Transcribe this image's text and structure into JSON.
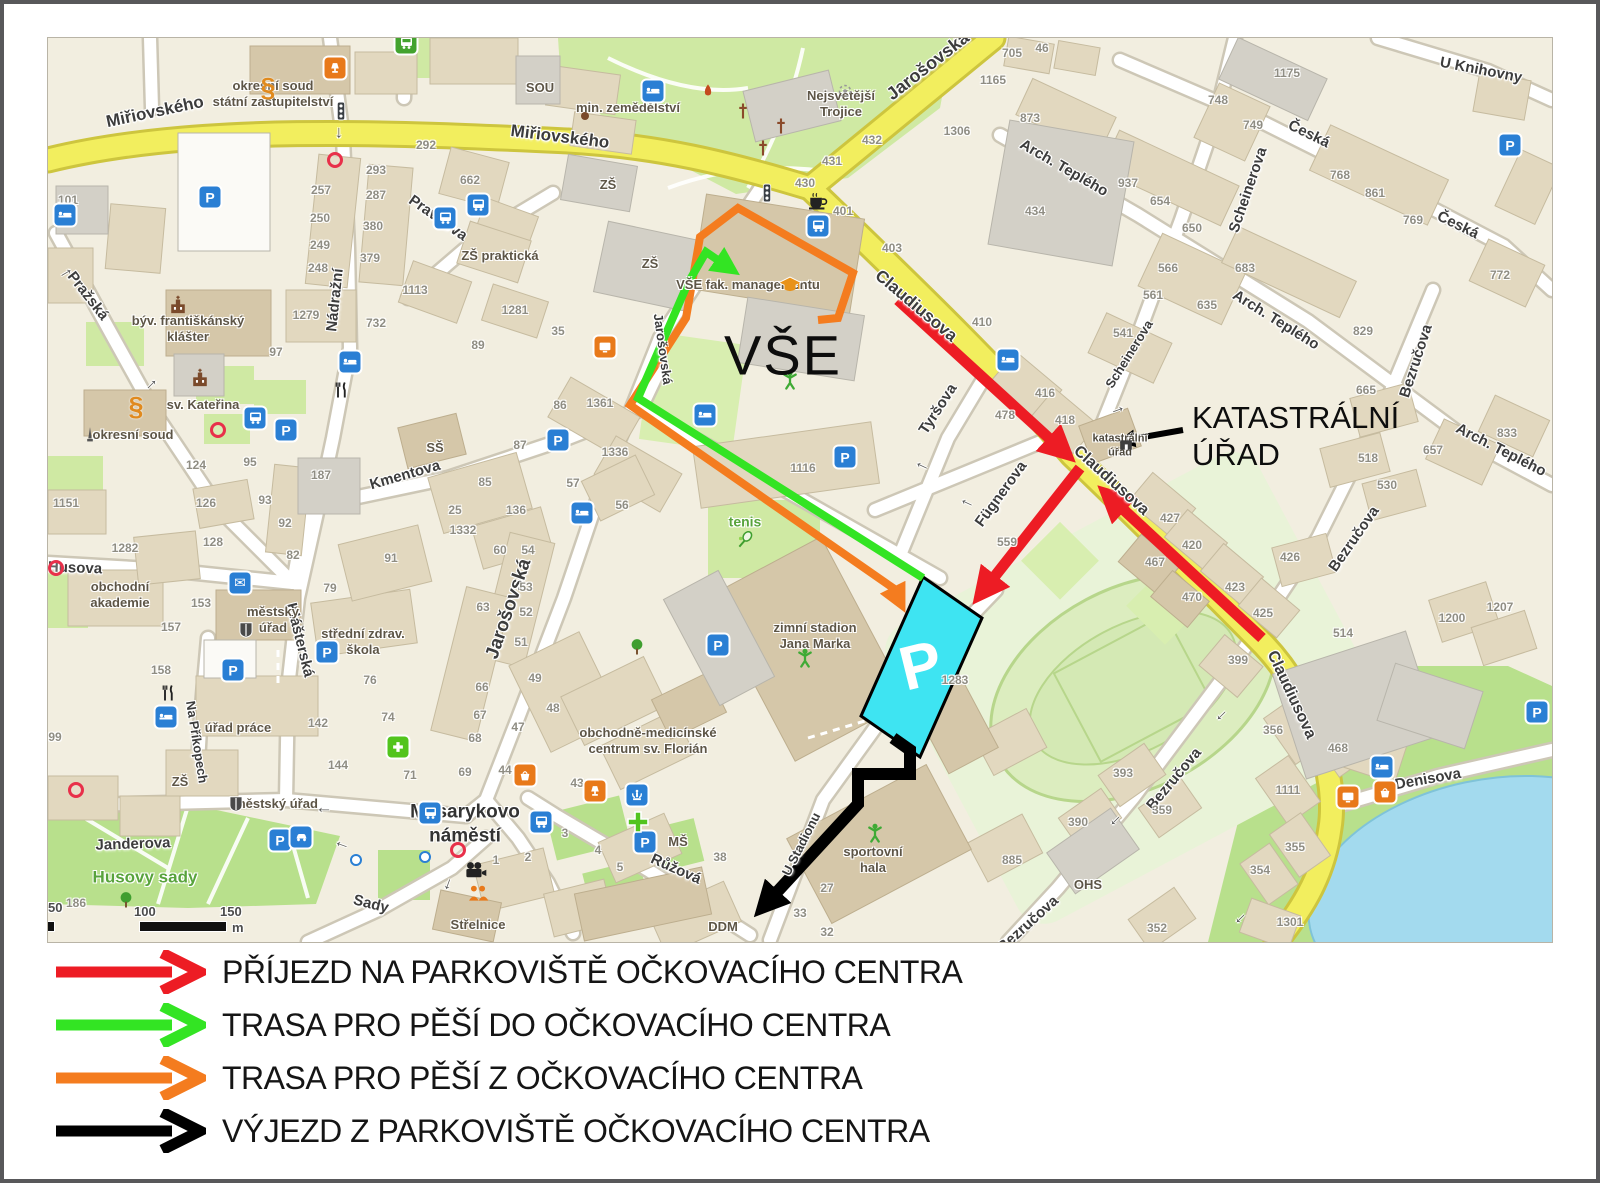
{
  "colors": {
    "route_arrival": "#ed1c24",
    "route_walk_to": "#33e423",
    "route_walk_from": "#f47c1f",
    "route_exit": "#000000",
    "parking_fill": "#3ee4f2",
    "road_main": "#f2ee5e",
    "water": "#a3daee"
  },
  "legend": {
    "items": [
      {
        "id": "arrival",
        "color": "#ed1c24",
        "label": "PŘÍJEZD NA PARKOVIŠTĚ OČKOVACÍHO CENTRA"
      },
      {
        "id": "walk-to",
        "color": "#33e423",
        "label": "TRASA PRO PĚŠÍ DO OČKOVACÍHO CENTRA"
      },
      {
        "id": "walk-from",
        "color": "#f47c1f",
        "label": "TRASA PRO PĚŠÍ Z OČKOVACÍHO CENTRA"
      },
      {
        "id": "exit",
        "color": "#000000",
        "label": "VÝJEZD Z PARKOVIŠTĚ OČKOVACÍHO CENTRA"
      }
    ]
  },
  "map": {
    "big_label": "VŠE",
    "parking_letter": "P",
    "callout": {
      "line1": "KATASTRÁLNÍ",
      "line2": "ÚŘAD"
    },
    "scale": {
      "t50": "50",
      "t100": "100",
      "t150": "150",
      "unit": "m"
    },
    "street_labels": [
      {
        "t": "Miřiovského",
        "x": 107,
        "y": 74,
        "r": -12,
        "s": 17
      },
      {
        "t": "Miřiovského",
        "x": 512,
        "y": 99,
        "r": 7,
        "s": 17
      },
      {
        "t": "Jarošovská",
        "x": 880,
        "y": 28,
        "r": -38,
        "s": 18
      },
      {
        "t": "Claudiusova",
        "x": 868,
        "y": 268,
        "r": 40,
        "s": 17
      },
      {
        "t": "Claudiusova",
        "x": 1063,
        "y": 443,
        "r": 42,
        "s": 16
      },
      {
        "t": "Claudiusova",
        "x": 1243,
        "y": 657,
        "r": 65,
        "s": 16
      },
      {
        "t": "Nádražní",
        "x": 287,
        "y": 262,
        "r": -84
      },
      {
        "t": "Pravdova",
        "x": 390,
        "y": 180,
        "r": 35
      },
      {
        "t": "Pražská",
        "x": 40,
        "y": 258,
        "r": 52
      },
      {
        "t": "Kmentova",
        "x": 357,
        "y": 437,
        "r": -16
      },
      {
        "t": "Klášterská",
        "x": 252,
        "y": 602,
        "r": 76
      },
      {
        "t": "Husova",
        "x": 27,
        "y": 530,
        "r": 2
      },
      {
        "t": "Janderova",
        "x": 85,
        "y": 806,
        "r": -2
      },
      {
        "t": "Na Příkopech",
        "x": 149,
        "y": 704,
        "r": 81,
        "s": 13
      },
      {
        "t": "Sady",
        "x": 323,
        "y": 866,
        "r": 14
      },
      {
        "t": "Růžová",
        "x": 628,
        "y": 831,
        "r": 24
      },
      {
        "t": "U Stadionu",
        "x": 753,
        "y": 806,
        "r": -63,
        "s": 13
      },
      {
        "t": "Tyršova",
        "x": 890,
        "y": 371,
        "r": -57
      },
      {
        "t": "Fügnerova",
        "x": 953,
        "y": 456,
        "r": -54
      },
      {
        "t": "Scheinerova",
        "x": 1200,
        "y": 152,
        "r": -71
      },
      {
        "t": "Scheinerova",
        "x": 1081,
        "y": 316,
        "r": -58,
        "s": 13
      },
      {
        "t": "Česká",
        "x": 1261,
        "y": 96,
        "r": 26
      },
      {
        "t": "Česká",
        "x": 1410,
        "y": 187,
        "r": 26
      },
      {
        "t": "U Knihovny",
        "x": 1433,
        "y": 32,
        "r": 11
      },
      {
        "t": "Arch. Teplého",
        "x": 1016,
        "y": 130,
        "r": 30
      },
      {
        "t": "Arch. Teplého",
        "x": 1228,
        "y": 282,
        "r": 32
      },
      {
        "t": "Arch. Teplého",
        "x": 1453,
        "y": 412,
        "r": 27
      },
      {
        "t": "Bezručova",
        "x": 1368,
        "y": 323,
        "r": -72
      },
      {
        "t": "Bezručova",
        "x": 1306,
        "y": 501,
        "r": -55
      },
      {
        "t": "Bezručova",
        "x": 1126,
        "y": 741,
        "r": -50
      },
      {
        "t": "Bezručova",
        "x": 980,
        "y": 886,
        "r": -42
      },
      {
        "t": "Denisova",
        "x": 1380,
        "y": 741,
        "r": -10
      },
      {
        "t": "Jarošovská",
        "x": 461,
        "y": 571,
        "r": -71,
        "s": 19
      },
      {
        "t": "Jarošovská",
        "x": 615,
        "y": 311,
        "r": 82,
        "s": 13
      }
    ],
    "place_labels": [
      {
        "t": "okresní soud\nstátní zastupitelství",
        "x": 225,
        "y": 56
      },
      {
        "t": "min. zemědělství",
        "x": 580,
        "y": 70
      },
      {
        "t": "Nejsvětější\nTrojice",
        "x": 793,
        "y": 66
      },
      {
        "t": "SOU",
        "x": 492,
        "y": 50
      },
      {
        "t": "ZŠ",
        "x": 560,
        "y": 147
      },
      {
        "t": "ZŠ",
        "x": 602,
        "y": 226
      },
      {
        "t": "ZŠ praktická",
        "x": 452,
        "y": 218
      },
      {
        "t": "ZŠ",
        "x": 132,
        "y": 744
      },
      {
        "t": "VŠE fak. managementu",
        "x": 700,
        "y": 247
      },
      {
        "t": "býv. františkánský\nklášter",
        "x": 140,
        "y": 291
      },
      {
        "t": "sv. Kateřina",
        "x": 155,
        "y": 367
      },
      {
        "t": "okresní soud",
        "x": 85,
        "y": 397
      },
      {
        "t": "obchodní\nakademie",
        "x": 72,
        "y": 557
      },
      {
        "t": "městský\núřad",
        "x": 225,
        "y": 582
      },
      {
        "t": "střední zdrav.\nškola",
        "x": 315,
        "y": 604
      },
      {
        "t": "SŠ",
        "x": 387,
        "y": 410
      },
      {
        "t": "úřad práce",
        "x": 190,
        "y": 690
      },
      {
        "t": "městský úřad",
        "x": 228,
        "y": 766
      },
      {
        "t": "obchodně-medicínské\ncentrum sv. Florián",
        "x": 600,
        "y": 703
      },
      {
        "t": "zimní stadion\nJana Marka",
        "x": 767,
        "y": 598
      },
      {
        "t": "sportovní\nhala",
        "x": 825,
        "y": 822
      },
      {
        "t": "tenis",
        "x": 697,
        "y": 484,
        "c": "g"
      },
      {
        "t": "MŠ",
        "x": 630,
        "y": 804
      },
      {
        "t": "DDM",
        "x": 675,
        "y": 889
      },
      {
        "t": "OHS",
        "x": 1040,
        "y": 847
      },
      {
        "t": "Střelnice",
        "x": 430,
        "y": 887
      },
      {
        "t": "Husovy sady",
        "x": 97,
        "y": 839,
        "c": "gb"
      },
      {
        "t": "katastrální\núřad",
        "x": 1072,
        "y": 408,
        "c": "sm"
      },
      {
        "t": "Masarykovo\nnáměstí",
        "x": 417,
        "y": 786,
        "c": "big"
      }
    ],
    "house_numbers": [
      [
        378,
        107,
        "292"
      ],
      [
        328,
        132,
        "293"
      ],
      [
        328,
        157,
        "287"
      ],
      [
        325,
        188,
        "380"
      ],
      [
        322,
        220,
        "379"
      ],
      [
        273,
        152,
        "257"
      ],
      [
        272,
        180,
        "250"
      ],
      [
        272,
        207,
        "249"
      ],
      [
        270,
        230,
        "248"
      ],
      [
        422,
        142,
        "662"
      ],
      [
        367,
        252,
        "1113"
      ],
      [
        467,
        272,
        "1281"
      ],
      [
        258,
        277,
        "1279"
      ],
      [
        328,
        285,
        "732"
      ],
      [
        20,
        162,
        "101"
      ],
      [
        824,
        102,
        "432"
      ],
      [
        784,
        123,
        "431"
      ],
      [
        757,
        145,
        "430"
      ],
      [
        795,
        173,
        "401"
      ],
      [
        844,
        210,
        "403"
      ],
      [
        909,
        93,
        "1306"
      ],
      [
        945,
        42,
        "1165"
      ],
      [
        934,
        284,
        "410"
      ],
      [
        510,
        293,
        "35"
      ],
      [
        964,
        15,
        "705"
      ],
      [
        994,
        10,
        "46"
      ],
      [
        982,
        80,
        "873"
      ],
      [
        987,
        173,
        "434"
      ],
      [
        1080,
        145,
        "937"
      ],
      [
        1112,
        163,
        "654"
      ],
      [
        1144,
        190,
        "650"
      ],
      [
        1239,
        35,
        "1175"
      ],
      [
        1170,
        62,
        "748"
      ],
      [
        1205,
        87,
        "749"
      ],
      [
        1292,
        137,
        "768"
      ],
      [
        1327,
        155,
        "861"
      ],
      [
        1365,
        182,
        "769"
      ],
      [
        1120,
        230,
        "566"
      ],
      [
        1105,
        257,
        "561"
      ],
      [
        1159,
        267,
        "635"
      ],
      [
        1075,
        295,
        "541"
      ],
      [
        1197,
        230,
        "683"
      ],
      [
        1452,
        237,
        "772"
      ],
      [
        1315,
        293,
        "829"
      ],
      [
        997,
        355,
        "416"
      ],
      [
        957,
        377,
        "478"
      ],
      [
        1017,
        382,
        "418"
      ],
      [
        1122,
        480,
        "427"
      ],
      [
        1144,
        507,
        "420"
      ],
      [
        1107,
        524,
        "467"
      ],
      [
        1144,
        559,
        "470"
      ],
      [
        1187,
        549,
        "423"
      ],
      [
        1215,
        575,
        "425"
      ],
      [
        959,
        504,
        "559"
      ],
      [
        1242,
        519,
        "426"
      ],
      [
        1320,
        420,
        "518"
      ],
      [
        1339,
        447,
        "530"
      ],
      [
        1318,
        352,
        "665"
      ],
      [
        1385,
        412,
        "657"
      ],
      [
        1459,
        395,
        "833"
      ],
      [
        1452,
        569,
        "1207"
      ],
      [
        1404,
        580,
        "1200"
      ],
      [
        1295,
        595,
        "514"
      ],
      [
        1190,
        622,
        "399"
      ],
      [
        552,
        365,
        "1361"
      ],
      [
        567,
        414,
        "1336"
      ],
      [
        525,
        445,
        "57"
      ],
      [
        574,
        467,
        "56"
      ],
      [
        755,
        430,
        "1116"
      ],
      [
        228,
        314,
        "97"
      ],
      [
        430,
        307,
        "89"
      ],
      [
        512,
        367,
        "86"
      ],
      [
        472,
        407,
        "87"
      ],
      [
        437,
        444,
        "85"
      ],
      [
        407,
        472,
        "25"
      ],
      [
        468,
        472,
        "136"
      ],
      [
        415,
        492,
        "1332"
      ],
      [
        452,
        512,
        "60"
      ],
      [
        480,
        512,
        "54"
      ],
      [
        478,
        549,
        "53"
      ],
      [
        478,
        574,
        "52"
      ],
      [
        473,
        604,
        "51"
      ],
      [
        148,
        427,
        "124"
      ],
      [
        158,
        465,
        "126"
      ],
      [
        165,
        504,
        "128"
      ],
      [
        77,
        510,
        "1282"
      ],
      [
        18,
        465,
        "1151"
      ],
      [
        202,
        424,
        "95"
      ],
      [
        217,
        462,
        "93"
      ],
      [
        237,
        485,
        "92"
      ],
      [
        245,
        517,
        "82"
      ],
      [
        343,
        520,
        "91"
      ],
      [
        282,
        550,
        "79"
      ],
      [
        273,
        437,
        "187"
      ],
      [
        153,
        565,
        "153"
      ],
      [
        123,
        589,
        "157"
      ],
      [
        435,
        569,
        "63"
      ],
      [
        434,
        649,
        "66"
      ],
      [
        432,
        677,
        "67"
      ],
      [
        427,
        700,
        "68"
      ],
      [
        417,
        734,
        "69"
      ],
      [
        457,
        732,
        "44"
      ],
      [
        529,
        745,
        "43"
      ],
      [
        470,
        689,
        "47"
      ],
      [
        505,
        670,
        "48"
      ],
      [
        487,
        640,
        "49"
      ],
      [
        322,
        642,
        "76"
      ],
      [
        340,
        679,
        "74"
      ],
      [
        362,
        737,
        "71"
      ],
      [
        270,
        685,
        "142"
      ],
      [
        290,
        727,
        "144"
      ],
      [
        113,
        632,
        "158"
      ],
      [
        7,
        699,
        "99"
      ],
      [
        28,
        865,
        "186"
      ],
      [
        448,
        822,
        "1"
      ],
      [
        480,
        819,
        "2"
      ],
      [
        672,
        819,
        "38"
      ],
      [
        779,
        850,
        "27"
      ],
      [
        752,
        875,
        "33"
      ],
      [
        779,
        894,
        "32"
      ],
      [
        517,
        795,
        "3"
      ],
      [
        550,
        812,
        "4"
      ],
      [
        572,
        829,
        "5"
      ],
      [
        964,
        822,
        "885"
      ],
      [
        907,
        642,
        "1283"
      ],
      [
        1225,
        692,
        "356"
      ],
      [
        1290,
        710,
        "468"
      ],
      [
        1240,
        752,
        "1111"
      ],
      [
        1075,
        735,
        "393"
      ],
      [
        1030,
        784,
        "390"
      ],
      [
        1114,
        772,
        "359"
      ],
      [
        1247,
        809,
        "355"
      ],
      [
        1212,
        832,
        "354"
      ],
      [
        1109,
        890,
        "352"
      ],
      [
        1242,
        884,
        "1301"
      ]
    ],
    "icons": [
      [
        "parking",
        162,
        159
      ],
      [
        "parking",
        238,
        392
      ],
      [
        "parking",
        232,
        802
      ],
      [
        "parking",
        797,
        419
      ],
      [
        "parking",
        510,
        402
      ],
      [
        "parking",
        279,
        614
      ],
      [
        "parking",
        185,
        632
      ],
      [
        "parking",
        670,
        607
      ],
      [
        "parking",
        597,
        804
      ],
      [
        "parking",
        1462,
        107
      ],
      [
        "parking",
        1489,
        674
      ],
      [
        "bed",
        17,
        177
      ],
      [
        "bed",
        605,
        53
      ],
      [
        "bed",
        960,
        322
      ],
      [
        "bed",
        657,
        377
      ],
      [
        "bed",
        534,
        475
      ],
      [
        "bed",
        302,
        324
      ],
      [
        "bed",
        118,
        679
      ],
      [
        "bed",
        1334,
        729
      ],
      [
        "bus",
        397,
        180
      ],
      [
        "bus",
        430,
        167
      ],
      [
        "bus",
        770,
        188
      ],
      [
        "bus",
        207,
        380
      ],
      [
        "bus",
        382,
        775
      ],
      [
        "bus",
        493,
        784
      ],
      [
        "bus_green",
        358,
        5
      ],
      [
        "taxi",
        253,
        799
      ],
      [
        "mail",
        192,
        545
      ],
      [
        "fountain",
        589,
        757
      ],
      [
        "coffee",
        770,
        163
      ],
      [
        "restaurant",
        293,
        352
      ],
      [
        "restaurant",
        120,
        655
      ],
      [
        "paragraph",
        220,
        50
      ],
      [
        "paragraph",
        88,
        369
      ],
      [
        "pharmacy",
        350,
        709
      ],
      [
        "cross_green",
        590,
        784
      ],
      [
        "tree",
        589,
        609
      ],
      [
        "tree",
        78,
        862
      ],
      [
        "playground",
        742,
        342
      ],
      [
        "playground",
        757,
        620
      ],
      [
        "playground",
        827,
        795
      ],
      [
        "tennis",
        697,
        502
      ],
      [
        "grad_cap",
        742,
        247
      ],
      [
        "tv",
        557,
        309
      ],
      [
        "tv",
        1300,
        759
      ],
      [
        "basket",
        477,
        737
      ],
      [
        "basket",
        1337,
        754
      ],
      [
        "lamp",
        287,
        30
      ],
      [
        "lamp",
        547,
        753
      ],
      [
        "camera",
        428,
        832
      ],
      [
        "people",
        430,
        855
      ],
      [
        "church",
        130,
        267
      ],
      [
        "church",
        152,
        340
      ],
      [
        "dome",
        537,
        78
      ],
      [
        "cross",
        695,
        73
      ],
      [
        "cross",
        733,
        88
      ],
      [
        "cross",
        715,
        110
      ],
      [
        "flame",
        660,
        53
      ],
      [
        "ring_dot",
        797,
        53
      ],
      [
        "monument",
        42,
        397
      ],
      [
        "shield",
        198,
        592
      ],
      [
        "shield",
        188,
        766
      ],
      [
        "signal",
        293,
        73
      ],
      [
        "signal",
        719,
        155
      ],
      [
        "circle_red",
        287,
        122
      ],
      [
        "circle_red",
        170,
        392
      ],
      [
        "circle_red",
        8,
        530
      ],
      [
        "circle_red",
        28,
        752
      ],
      [
        "circle_red",
        410,
        812
      ],
      [
        "dot_blue",
        377,
        819
      ],
      [
        "dot_blue",
        308,
        822
      ],
      [
        "arrow",
        293,
        95,
        90
      ],
      [
        "arrow",
        873,
        430,
        205
      ],
      [
        "arrow",
        918,
        467,
        205
      ],
      [
        "arrow",
        276,
        774,
        180
      ],
      [
        "arrow",
        293,
        809,
        200
      ],
      [
        "arrow",
        1175,
        679,
        135
      ],
      [
        "arrow",
        1069,
        784,
        135
      ],
      [
        "arrow",
        1194,
        882,
        135
      ],
      [
        "arrow",
        1069,
        370,
        -20
      ],
      [
        "arrow",
        102,
        345,
        -45
      ],
      [
        "arrow",
        17,
        233,
        -30
      ],
      [
        "arrow",
        402,
        847,
        110
      ],
      [
        "bldg_dark",
        1078,
        407
      ]
    ]
  }
}
